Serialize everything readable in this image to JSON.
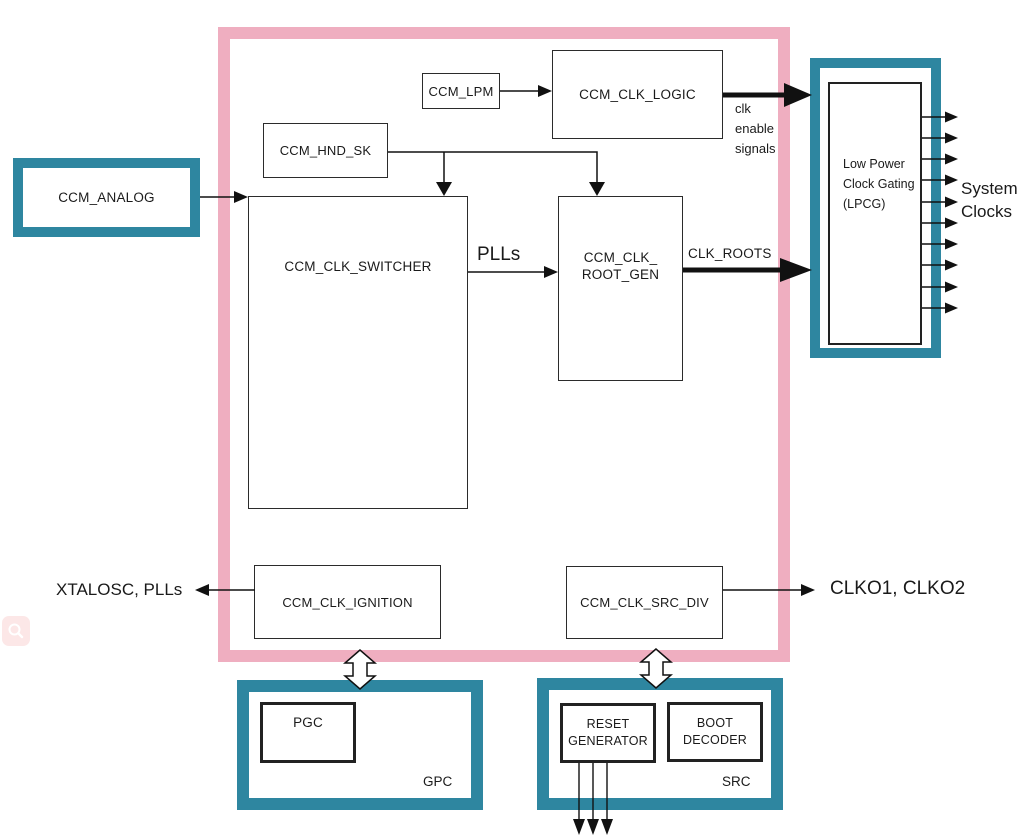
{
  "colors": {
    "pink": "#efaec0",
    "teal": "#2e86a0",
    "line": "#1a1a1a",
    "zoom-btn": "#fce7e7"
  },
  "blocks": {
    "analog": "CCM_ANALOG",
    "lpm": "CCM_LPM",
    "clk_logic": "CCM_CLK_LOGIC",
    "hnd_sk": "CCM_HND_SK",
    "switcher": "CCM_CLK_SWITCHER",
    "root_gen": "CCM_CLK_\nROOT_GEN",
    "ignition": "CCM_CLK_IGNITION",
    "src_div": "CCM_CLK_SRC_DIV",
    "lpcg": "Low Power\nClock Gating\n(LPCG)",
    "pgc": "PGC",
    "gpc": "GPC",
    "reset_generator": "RESET\nGENERATOR",
    "boot_decoder": "BOOT\nDECODER",
    "src": "SRC"
  },
  "labels": {
    "clk_enable": "clk\nenable\nsignals",
    "plls": "PLLs",
    "clk_roots": "CLK_ROOTS",
    "system_clocks": "System\nClocks",
    "xtalosc_plls": "XTALOSC, PLLs",
    "clko": "CLKO1, CLKO2"
  },
  "icons": {
    "zoom_button": "magnifier-icon"
  }
}
